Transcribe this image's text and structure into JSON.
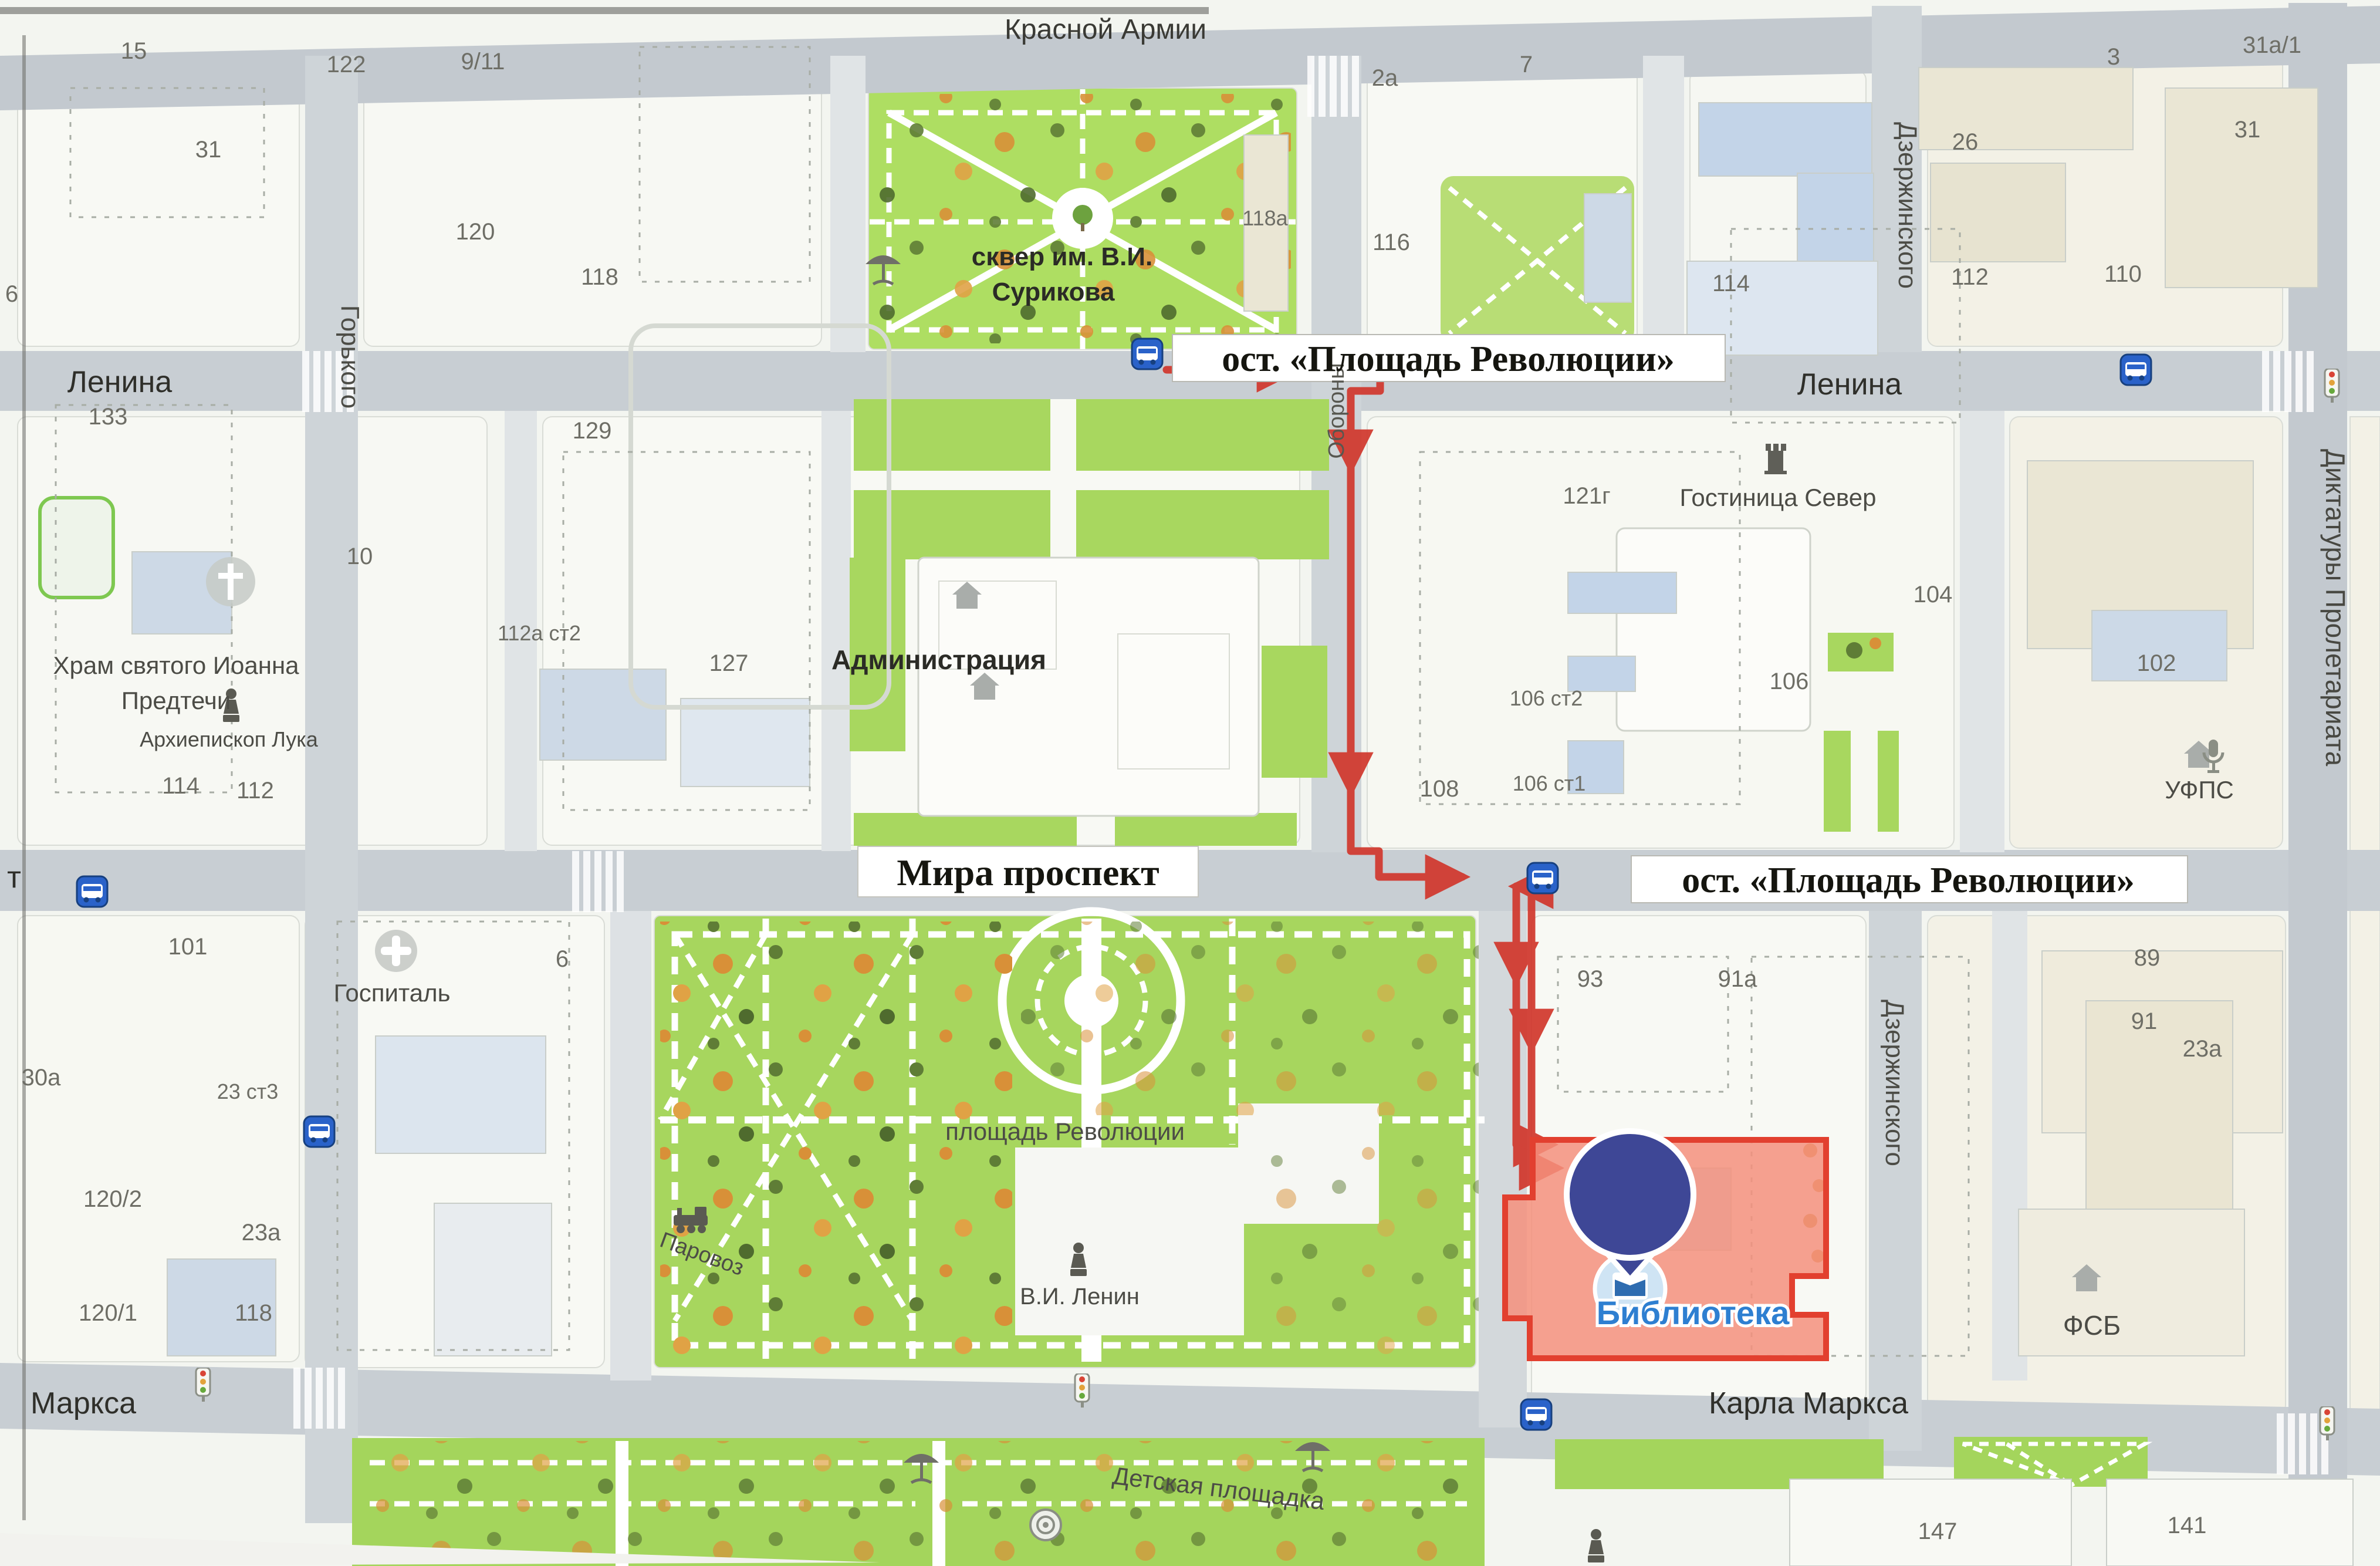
{
  "map": {
    "streets": {
      "krasnoy_armii": "Красной Армии",
      "lenina_left": "Ленина",
      "lenina_right": "Ленина",
      "gorkogo": "Горького",
      "oborony": "Обороны",
      "dzerzhinskogo_top": "Дзержинского",
      "dzerzhinskogo_bottom": "Дзержинского",
      "diktatury": "Диктатуры Пролетариата",
      "mira": "Мира проспект",
      "marksa": "Маркса",
      "karla_marksa": "Карла Маркса",
      "edge_cut_label": "т"
    },
    "stops": {
      "stop1": "ост. «Площадь Революции»",
      "stop2": "ост. «Площадь Революции»"
    },
    "pois": {
      "skver_line1": "сквер им. В.И.",
      "skver_line2": "Сурикова",
      "administration": "Администрация",
      "hotel": "Гостиница Север",
      "church_line1": "Храм святого Иоанна",
      "church_line2": "Предтечи",
      "luka": "Архиепископ Лука",
      "hospital": "Госпиталь",
      "revolution_square": "площадь Революции",
      "parovoz": "Паровоз",
      "lenin_monument": "В.И. Ленин",
      "library": "Библиотека",
      "ufps": "УФПС",
      "fsb": "ФСБ",
      "playground": "Детская площадка"
    },
    "houseNumbers": [
      "15",
      "122",
      "9/11",
      "31",
      "120",
      "118",
      "6",
      "2а",
      "7",
      "3",
      "31а/1",
      "26",
      "31",
      "118а",
      "116",
      "114",
      "112",
      "110",
      "133",
      "129",
      "10",
      "112а ст2",
      "127",
      "121г",
      "104",
      "102",
      "106 ст2",
      "106",
      "106 ст1",
      "108",
      "114",
      "112",
      "101",
      "6",
      "93",
      "91а",
      "89",
      "91",
      "23а",
      "30а",
      "23 ст3",
      "120/2",
      "23а",
      "120/1",
      "118",
      "147",
      "141"
    ],
    "colors": {
      "route": "#d1372c",
      "pin": "#3e4796",
      "library_fill": "#f5917c",
      "library_stroke": "#e2402f",
      "park": "#a7d65e",
      "road": "#c8ced3",
      "bus_icon": "#2a62c9"
    }
  }
}
